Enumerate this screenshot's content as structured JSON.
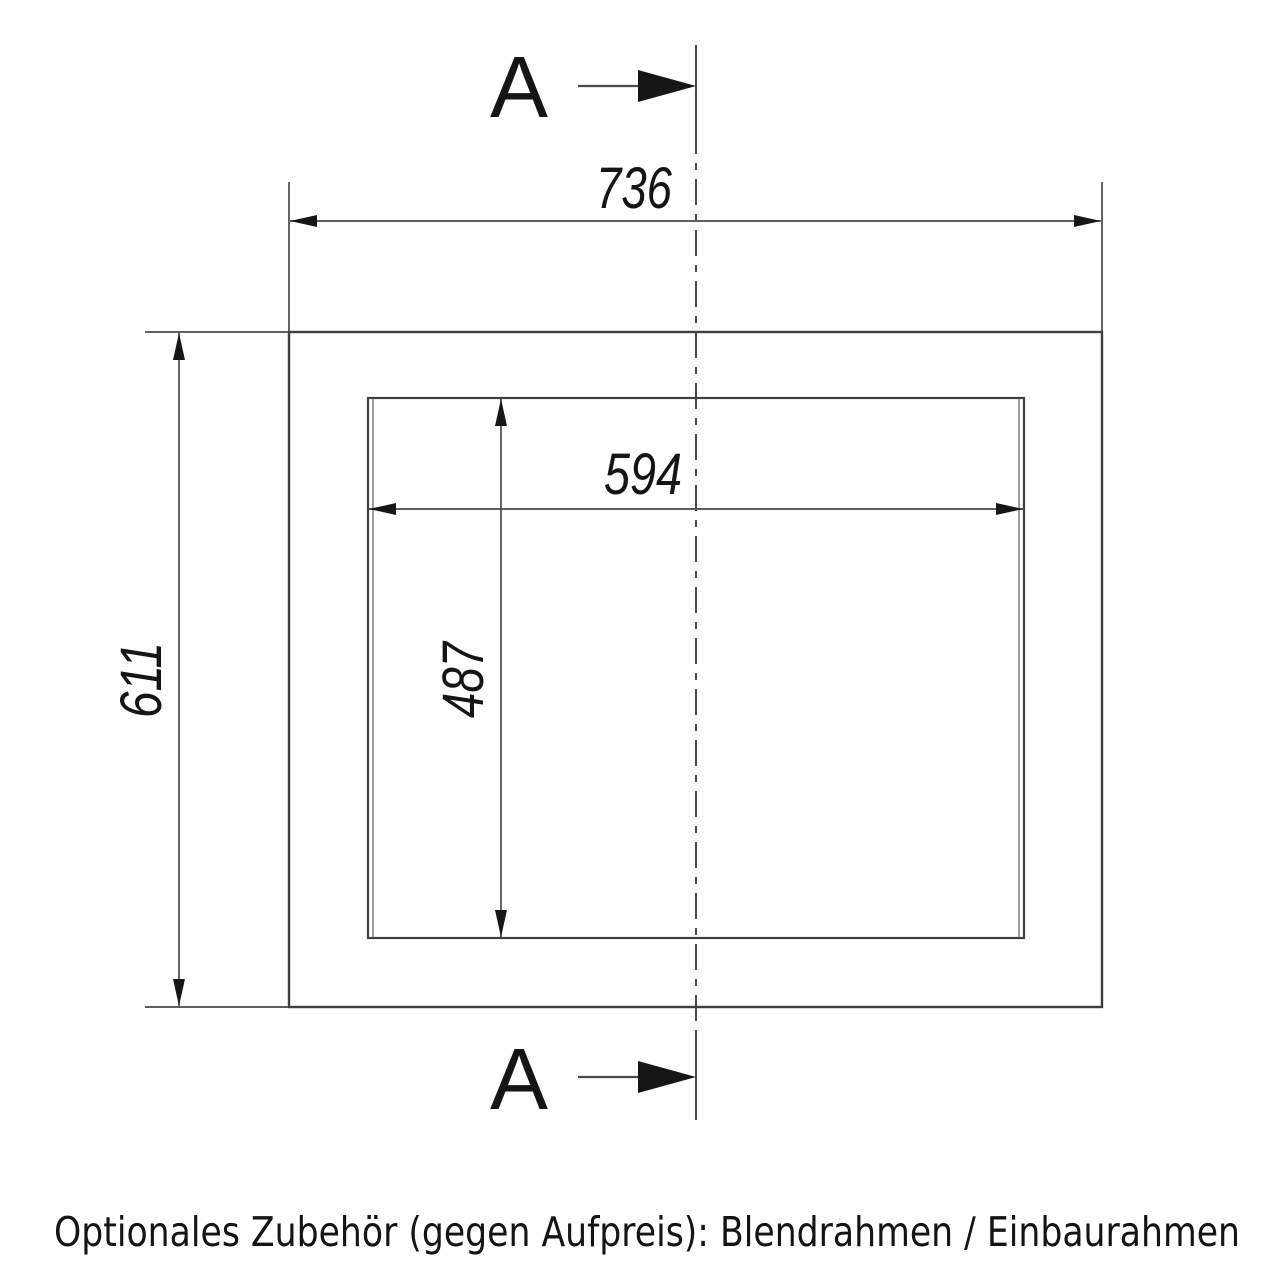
{
  "drawing": {
    "type": "technical-installation-drawing",
    "section_marker": {
      "top_label": "A",
      "bottom_label": "A"
    },
    "dimensions": {
      "outer_width": "736",
      "outer_height": "611",
      "inner_width": "594",
      "inner_height": "487"
    }
  },
  "caption": "Optionales Zubehör (gegen Aufpreis): Blendrahmen / Einbaurahmen",
  "colors": {
    "background": "#ffffff",
    "line": "#3f3f3f",
    "ink": "#151515"
  }
}
